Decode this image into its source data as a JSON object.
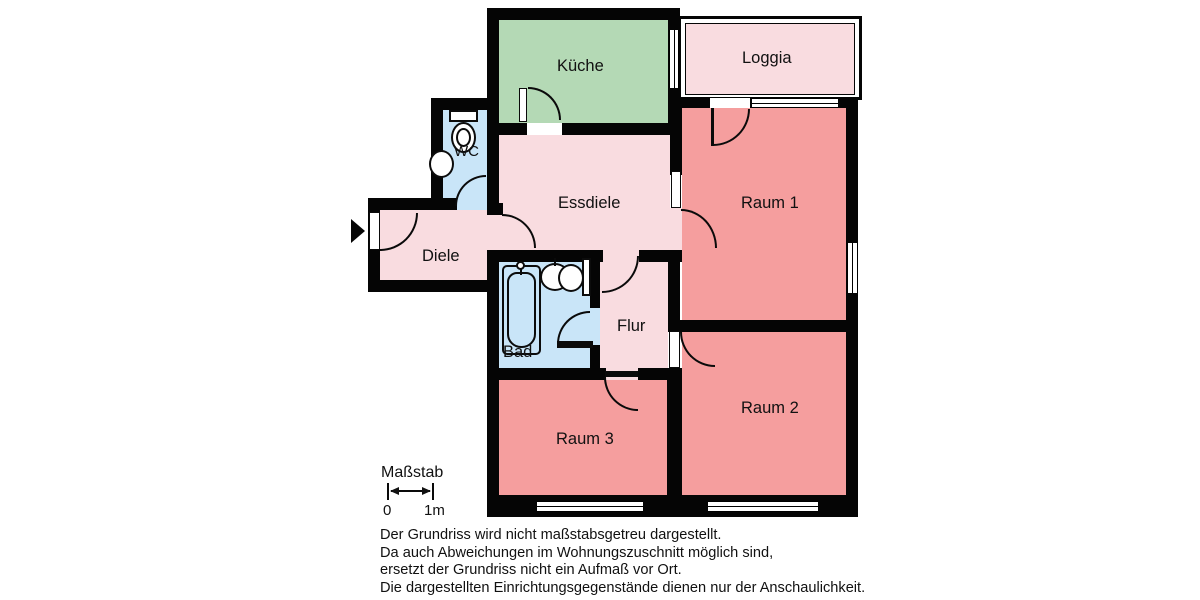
{
  "rooms": {
    "kueche": {
      "label": "Küche"
    },
    "loggia": {
      "label": "Loggia"
    },
    "wc": {
      "label": "WC"
    },
    "essdiele": {
      "label": "Essdiele"
    },
    "diele": {
      "label": "Diele"
    },
    "raum1": {
      "label": "Raum 1"
    },
    "bad": {
      "label": "Bad"
    },
    "flur": {
      "label": "Flur"
    },
    "raum2": {
      "label": "Raum 2"
    },
    "raum3": {
      "label": "Raum 3"
    }
  },
  "scale": {
    "label": "Maßstab",
    "start": "0",
    "end": "1m"
  },
  "disclaimer": {
    "line1": "Der Grundriss wird nicht maßstabsgetreu dargestellt.",
    "line2": "Da auch Abweichungen im Wohnungszuschnitt möglich sind,",
    "line3": "ersetzt der Grundriss nicht ein Aufmaß vor Ort.",
    "line4": "Die dargestellten Einrichtungsgegenstände dienen nur der Anschaulichkeit."
  },
  "colors": {
    "wall": "#050505",
    "kitchen_green": "#b4d9b5",
    "hall_pink": "#f9dce0",
    "room_salmon": "#f59e9e",
    "bath_blue": "#c9e5f8",
    "background": "#ffffff"
  }
}
